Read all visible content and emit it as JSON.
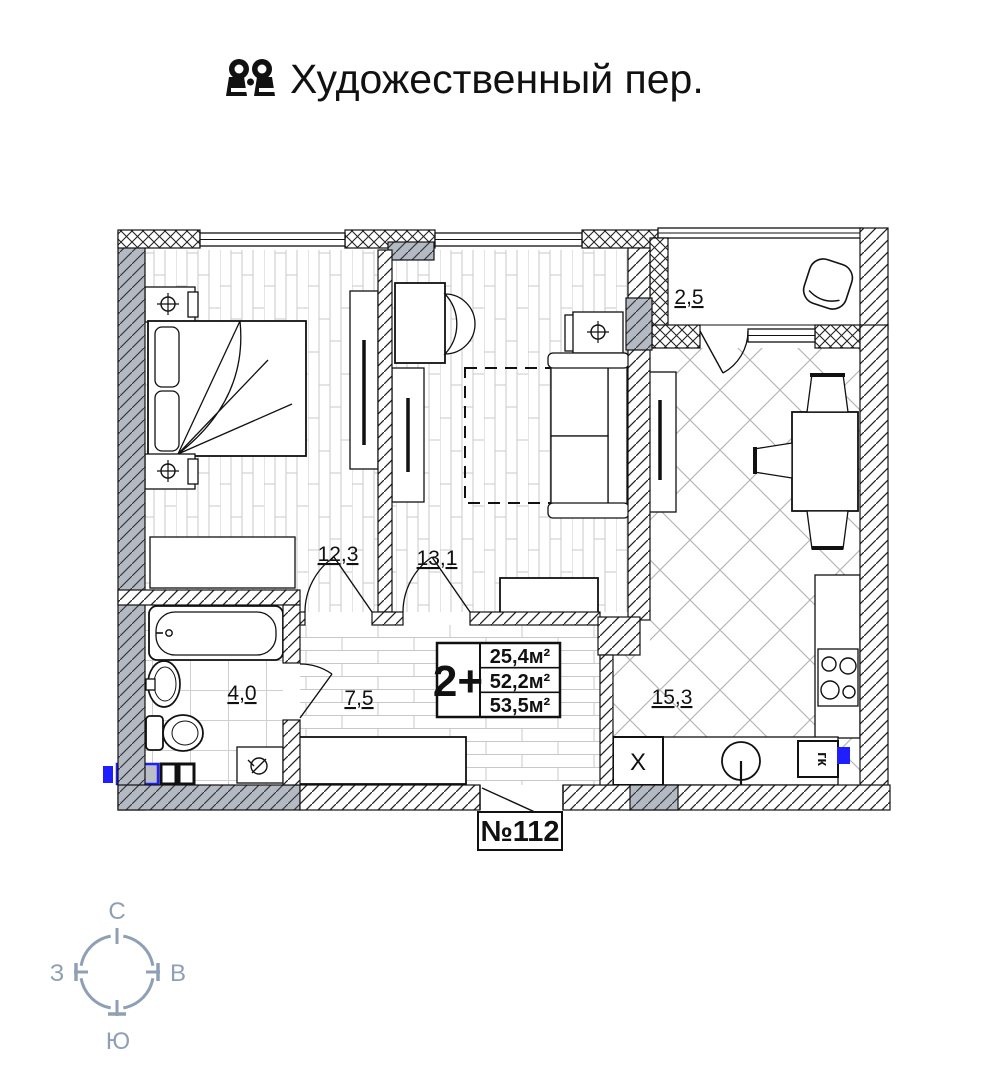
{
  "header": {
    "title": "Художественный пер.",
    "icon": "binoculars-icon"
  },
  "plan": {
    "apartment_number": "№112",
    "info_box": {
      "rooms_label": "2+",
      "areas": [
        "25,4м²",
        "52,2м²",
        "53,5м²"
      ]
    },
    "room_areas": {
      "bedroom": "12,3",
      "living_room": "13,1",
      "bathroom": "4,0",
      "hallway": "7,5",
      "kitchen": "15,3",
      "balcony": "2,5"
    },
    "fixtures": {
      "fridge_label": "Х",
      "boiler_label": "гк"
    }
  },
  "compass": {
    "north": "С",
    "south": "Ю",
    "west": "З",
    "east": "В"
  },
  "colors": {
    "wall_gray": "#b4bac4",
    "compass": "#8fa0b4",
    "riser_blue": "#1e1eff",
    "floor_line": "#c8c8c8"
  }
}
